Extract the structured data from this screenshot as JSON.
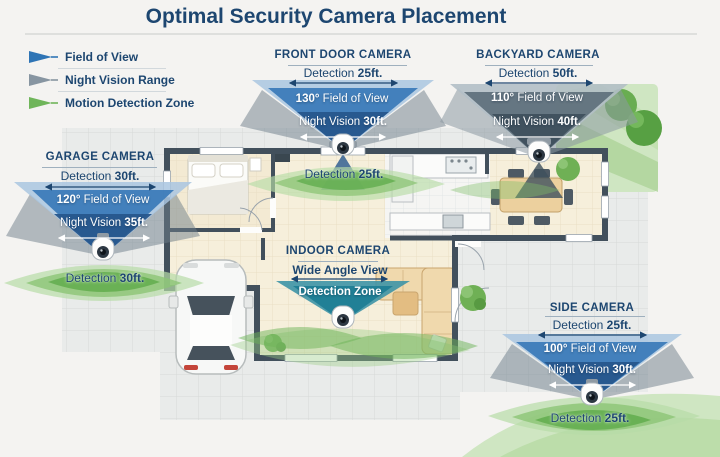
{
  "title": "Optimal Security Camera Placement",
  "legend": {
    "items": [
      {
        "id": "field-of-view",
        "label": "Field of View",
        "color": "#2e74b5"
      },
      {
        "id": "night-vision-range",
        "label": "Night Vision Range",
        "color": "#8795a1"
      },
      {
        "id": "motion-detection-zone",
        "label": "Motion Detection Zone",
        "color": "#6fb55a"
      }
    ]
  },
  "cameras": {
    "garage": {
      "name": "GARAGE CAMERA",
      "detection": {
        "prefix": "Detection",
        "value": "30ft."
      },
      "fov": {
        "value": "120°",
        "label": "Field of View"
      },
      "night_vision": {
        "prefix": "Night Vision",
        "value": "35ft."
      },
      "zone": {
        "prefix": "Detection",
        "value": "30ft."
      }
    },
    "front_door": {
      "name": "FRONT DOOR CAMERA",
      "detection": {
        "prefix": "Detection",
        "value": "25ft."
      },
      "fov": {
        "value": "130°",
        "label": "Field of View"
      },
      "night_vision": {
        "prefix": "Night Vision",
        "value": "30ft."
      },
      "zone": {
        "prefix": "Detection",
        "value": "25ft."
      }
    },
    "backyard": {
      "name": "BACKYARD CAMERA",
      "detection": {
        "prefix": "Detection",
        "value": "50ft."
      },
      "fov": {
        "value": "110°",
        "label": "Field of View"
      },
      "night_vision": {
        "prefix": "Night Vision",
        "value": "40ft."
      }
    },
    "indoor": {
      "name": "INDOOR CAMERA",
      "view_label": "Wide Angle View",
      "zone_label": "Detection Zone"
    },
    "side": {
      "name": "SIDE CAMERA",
      "detection": {
        "prefix": "Detection",
        "value": "25ft."
      },
      "fov": {
        "value": "100°",
        "label": "Field of View"
      },
      "night_vision": {
        "prefix": "Night Vision",
        "value": "30ft."
      },
      "zone": {
        "prefix": "Detection",
        "value": "25ft."
      }
    }
  },
  "colors": {
    "heading_navy": "#1d4670",
    "fov_blue": "#3a7ab8",
    "fov_light_blue": "#a9c6e0",
    "night_vision_navy": "#27568c",
    "night_range_gray": "#6e7e8a",
    "motion_green": "#62ad4e",
    "grass_green": "#cfe6c2",
    "indoor_teal": "#1f7e95",
    "wall_slate": "#42505c",
    "floor_cream": "#f6efdb"
  }
}
